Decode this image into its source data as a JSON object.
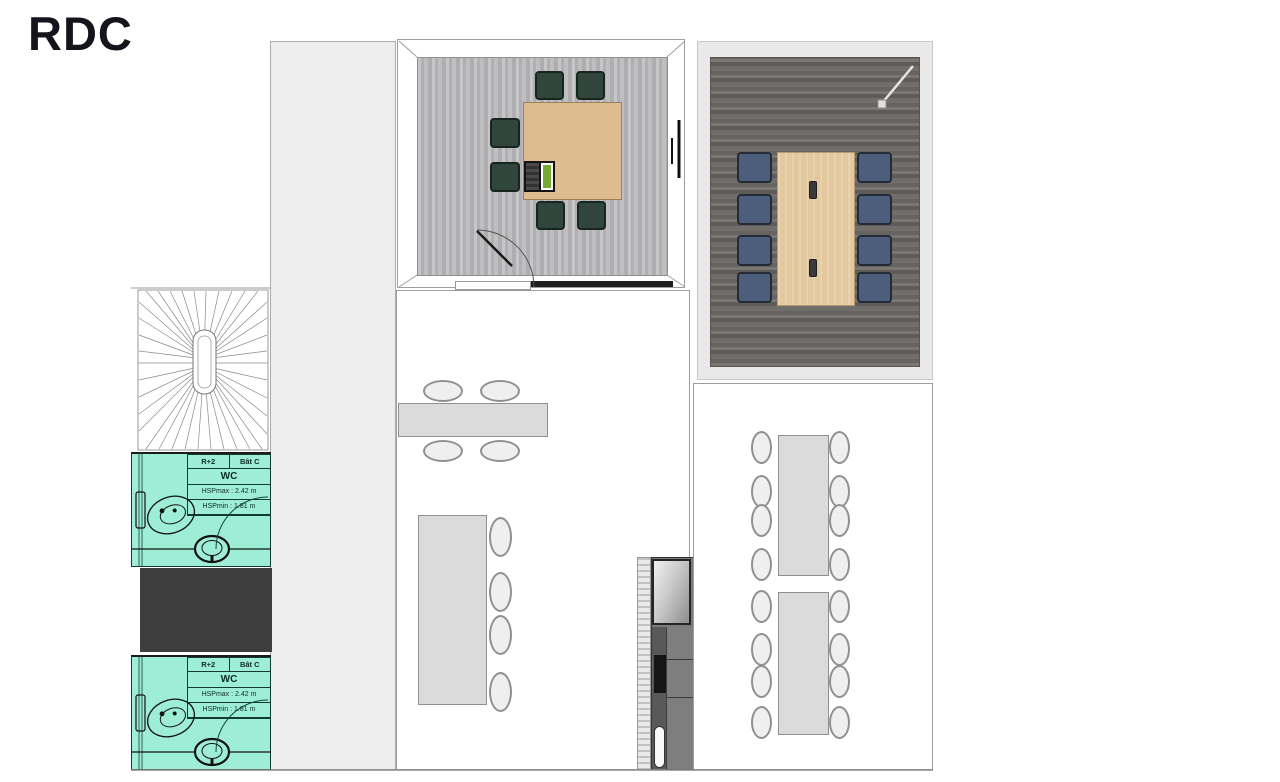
{
  "title": "RDC",
  "wc_units": [
    {
      "header_left": "R+2",
      "header_right": "Bât C",
      "name": "WC",
      "hsp_max": "HSPmax : 2.42 m",
      "hsp_min": "HSPmin : 1.81 m"
    },
    {
      "header_left": "R+2",
      "header_right": "Bât C",
      "name": "WC",
      "hsp_max": "HSPmax : 2.42 m",
      "hsp_min": "HSPmin : 1.81 m"
    }
  ],
  "colors": {
    "wc-fill": "#9EEED6",
    "wc-line": "#123B31",
    "wc-text": "#0D2C25",
    "chair-green": "#30463D",
    "chair-blue": "#4C5E7B",
    "table-wood-light": "#DDBC90",
    "table-wood-right": "#E3C89D",
    "table-gray": "#DBDBDB",
    "floor-light": "#B9B9BB",
    "floor-dark": "#6E6A66",
    "dark-block": "#3E3E3E",
    "corridor": "#EDEDED"
  }
}
